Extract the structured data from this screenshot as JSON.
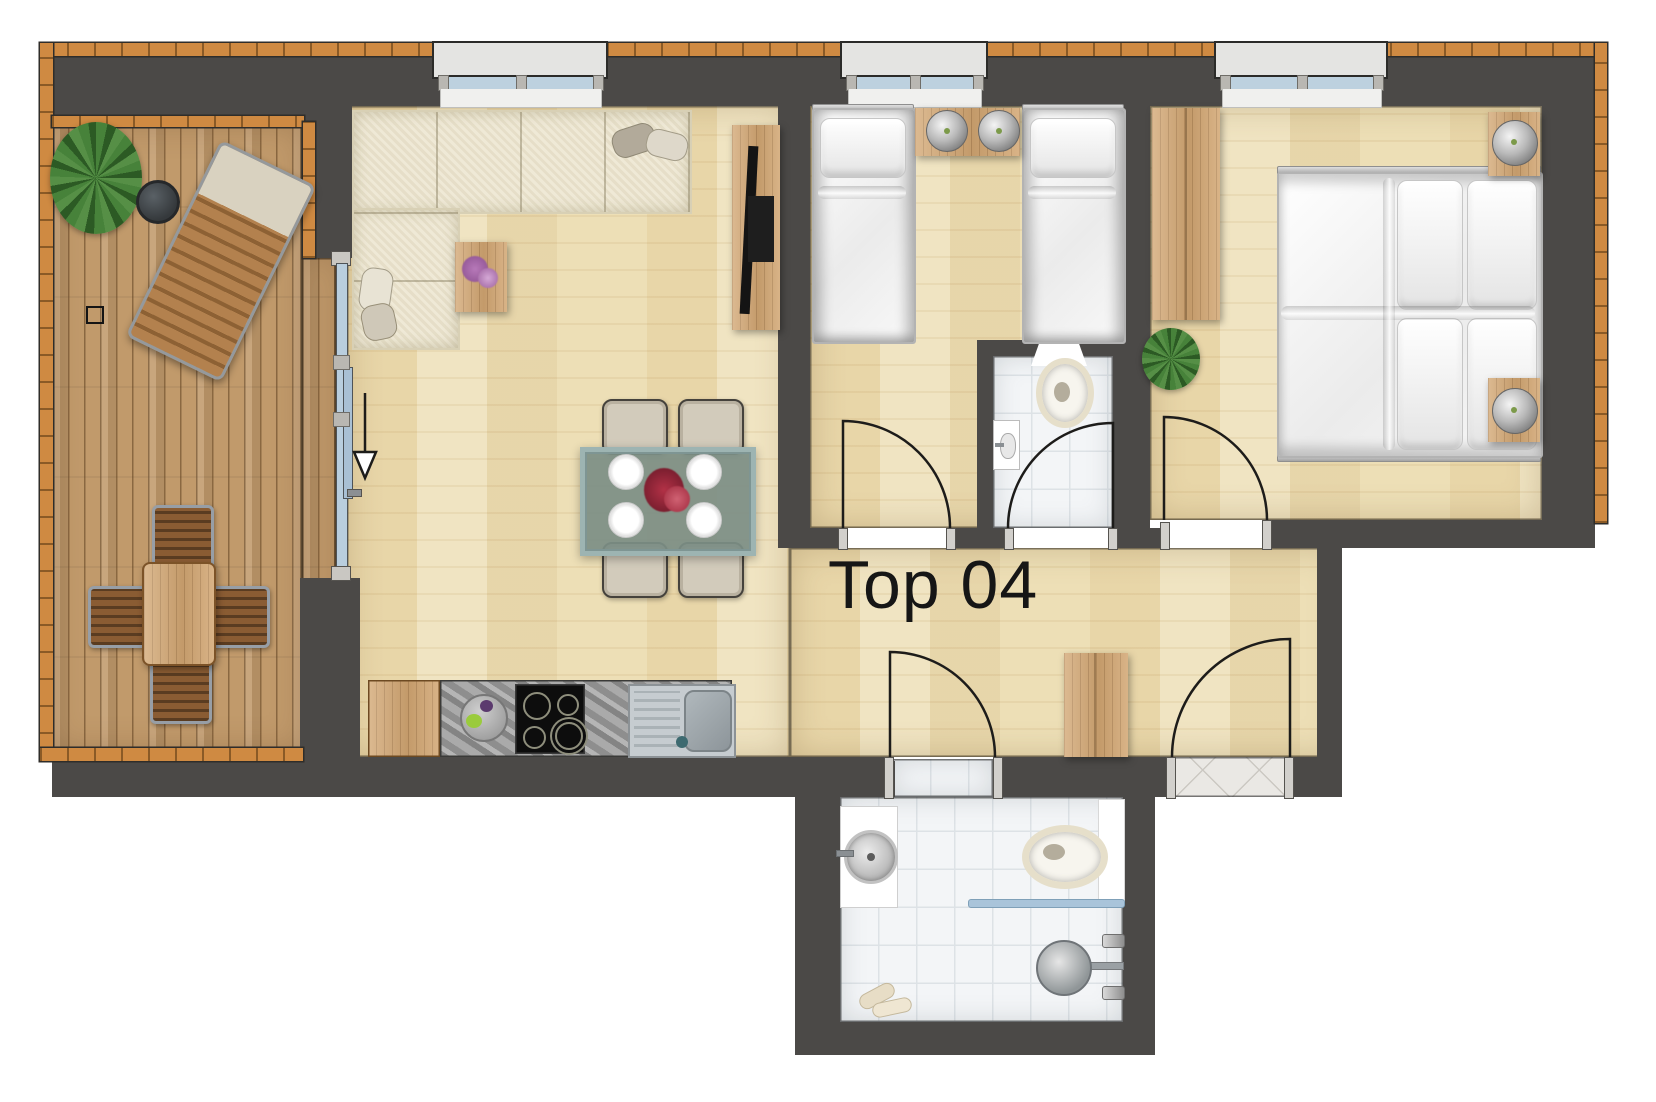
{
  "title": {
    "label": "Top 04"
  },
  "colors": {
    "wall": "#4b4947",
    "brick_border": "#cf8a42",
    "parquet_floor": "#eddfb6",
    "terrace_deck": "#c19a6b",
    "bathroom_tile": "#f3f5f7",
    "window_glass": "#bdd1df",
    "accent_blue": "#a9c4da",
    "furniture_wood": "#d2a672",
    "label_text": "#161616"
  }
}
